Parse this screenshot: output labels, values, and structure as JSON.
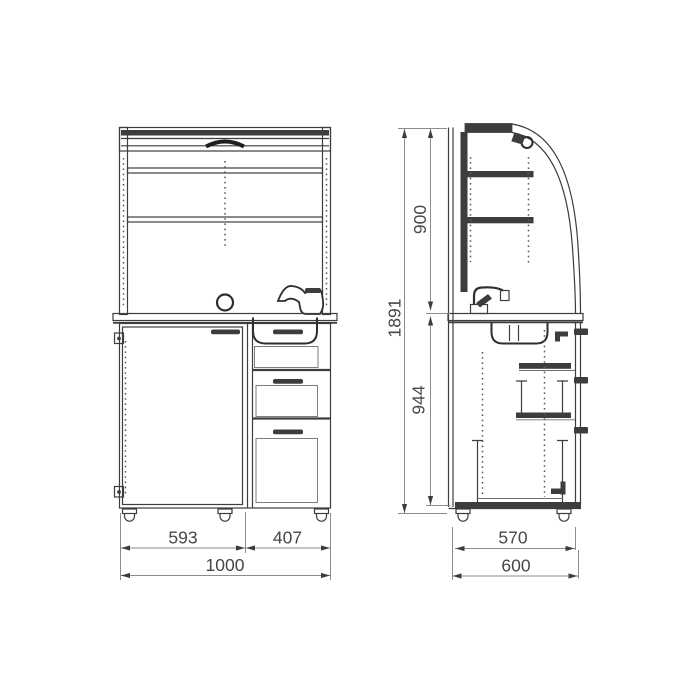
{
  "diagram": {
    "front_view": {
      "width_left": "593",
      "width_right": "407",
      "width_total": "1000"
    },
    "side_view": {
      "height_upper": "900",
      "height_lower": "944",
      "height_total": "1891",
      "depth_body": "570",
      "depth_total": "600"
    },
    "colors": {
      "line": "#3d3d3d",
      "dim_line": "#8c8c8c",
      "text": "#474747",
      "background": "#ffffff"
    }
  }
}
